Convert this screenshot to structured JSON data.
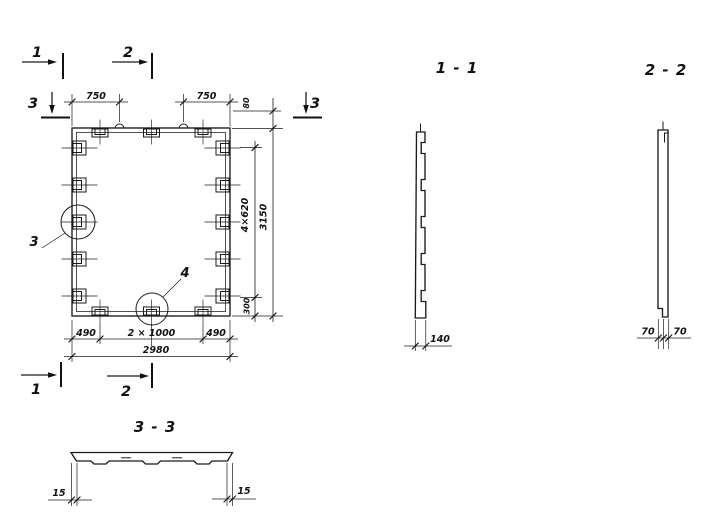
{
  "plan": {
    "markers": {
      "top1": "1",
      "top2": "2",
      "left3": "3",
      "right3": "3",
      "bottom1": "1",
      "bottom2": "2"
    },
    "details": {
      "circle3": "3",
      "circle4": "4"
    },
    "dims": {
      "top750L": "750",
      "top750R": "750",
      "right80": "80",
      "right4x620": "4×620",
      "right3150": "3150",
      "right300": "300",
      "bot490L": "490",
      "bot2x1000": "2 × 1000",
      "bot490R": "490",
      "bot2980": "2980"
    }
  },
  "sections": {
    "s11": {
      "title": "1 - 1",
      "thickness": "140"
    },
    "s22": {
      "title": "2 - 2",
      "left70": "70",
      "right70": "70"
    },
    "s33": {
      "title": "3 - 3",
      "left15": "15",
      "right15": "15"
    }
  }
}
